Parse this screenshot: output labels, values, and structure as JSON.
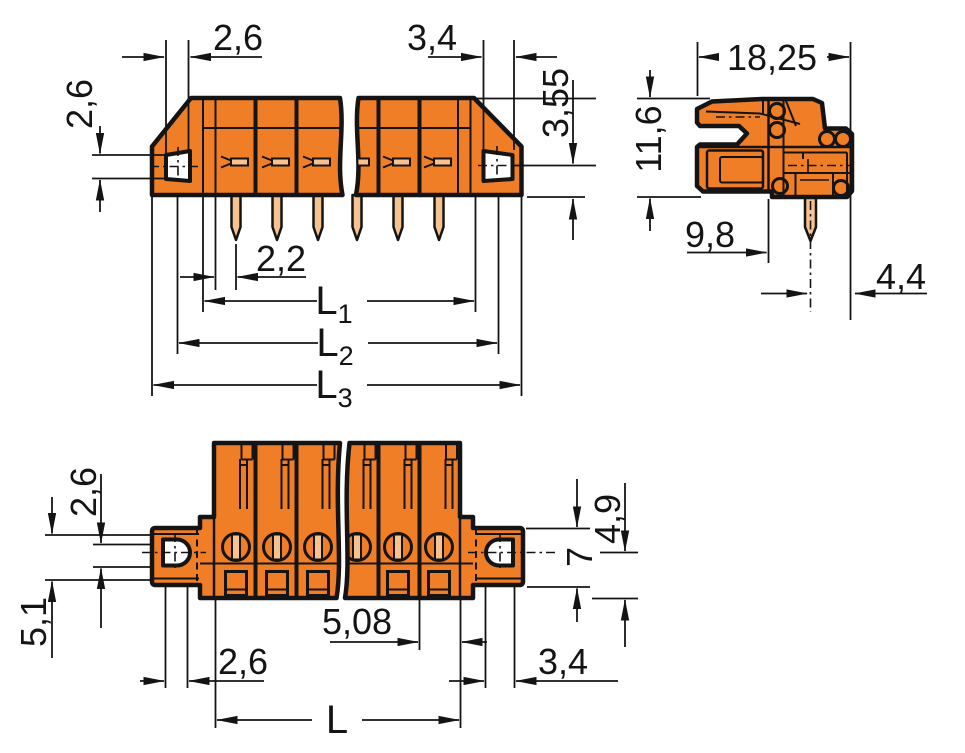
{
  "drawing": {
    "front_view": {
      "dim_top_left": "2,6",
      "dim_top_right": "3,4",
      "dim_hole_left": "2,6",
      "dim_pin_row_offset": "3,55",
      "dim_pin_offset": "2,2",
      "dim_l1": "L",
      "dim_l1_sub": "1",
      "dim_l2": "L",
      "dim_l2_sub": "2",
      "dim_l3": "L",
      "dim_l3_sub": "3"
    },
    "side_view": {
      "dim_width": "18,25",
      "dim_height": "11,6",
      "dim_depth": "9,8",
      "dim_pin_back": "4,4"
    },
    "bottom_view": {
      "dim_hole_height": "2,6",
      "dim_flange_span": "5,1",
      "dim_pitch": "5,08",
      "dim_slot_left": "2,6",
      "dim_length": "L",
      "dim_slot_right": "3,4",
      "dim_flange_height": "7",
      "dim_bottom_offset": "4,9"
    }
  },
  "colors": {
    "body": "#F07E26",
    "pin": "#F6C28F",
    "line": "#141414",
    "background": "#FFFFFF"
  }
}
